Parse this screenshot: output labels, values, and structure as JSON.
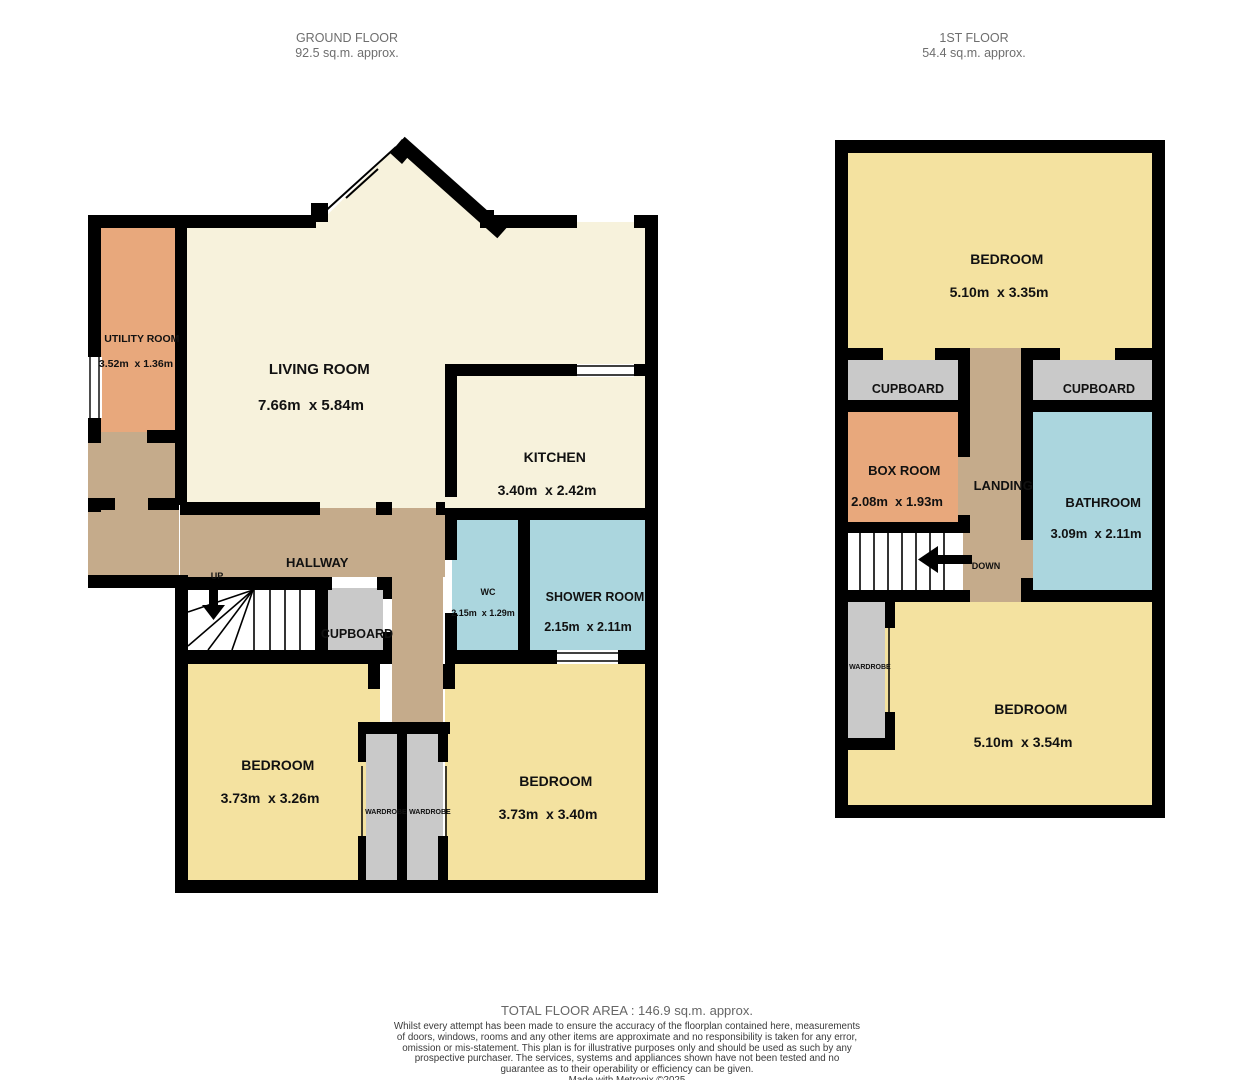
{
  "colors": {
    "wall": "#000000",
    "floor_cream": "#f7f2dc",
    "floor_yellow": "#f4e2a0",
    "floor_orange": "#e8a87c",
    "floor_tan": "#c5ab8b",
    "floor_blue": "#abd6de",
    "floor_gray": "#c9c9c9",
    "stair_white": "#ffffff",
    "header_text": "#6e6e6e",
    "label_text": "#111111",
    "footer_text": "#666666",
    "disclaimer_text": "#3a3a3a"
  },
  "ground_floor": {
    "header": {
      "title": "GROUND FLOOR",
      "area": "92.5 sq.m. approx."
    },
    "rooms": {
      "utility": {
        "name": "UTILITY ROOM",
        "dims": "3.52m  x 1.36m"
      },
      "living": {
        "name": "LIVING ROOM",
        "dims": "7.66m  x 5.84m"
      },
      "kitchen": {
        "name": "KITCHEN",
        "dims": "3.40m  x 2.42m"
      },
      "hallway": {
        "name": "HALLWAY"
      },
      "wc": {
        "name": "WC",
        "dims": "2.15m  x 1.29m"
      },
      "shower_room": {
        "name": "SHOWER ROOM",
        "dims": "2.15m  x 2.11m"
      },
      "cupboard": {
        "name": "CUPBOARD"
      },
      "bedroom_left": {
        "name": "BEDROOM",
        "dims": "3.73m  x 3.26m"
      },
      "bedroom_right": {
        "name": "BEDROOM",
        "dims": "3.73m  x 3.40m"
      },
      "wardrobe_left": {
        "name": "WARDROBE"
      },
      "wardrobe_right": {
        "name": "WARDROBE"
      }
    },
    "stairs": {
      "direction_label": "UP"
    }
  },
  "first_floor": {
    "header": {
      "title": "1ST FLOOR",
      "area": "54.4 sq.m. approx."
    },
    "rooms": {
      "bedroom_top": {
        "name": "BEDROOM",
        "dims": "5.10m  x 3.35m"
      },
      "cupboard_left": {
        "name": "CUPBOARD"
      },
      "cupboard_right": {
        "name": "CUPBOARD"
      },
      "box_room": {
        "name": "BOX ROOM",
        "dims": "2.08m  x 1.93m"
      },
      "landing": {
        "name": "LANDING"
      },
      "bathroom": {
        "name": "BATHROOM",
        "dims": "3.09m  x 2.11m"
      },
      "bedroom_bottom": {
        "name": "BEDROOM",
        "dims": "5.10m  x 3.54m"
      },
      "wardrobe": {
        "name": "WARDROBE"
      }
    },
    "stairs": {
      "direction_label": "DOWN"
    }
  },
  "footer": {
    "total_area": "TOTAL FLOOR AREA : 146.9 sq.m. approx.",
    "disclaimer": "Whilst every attempt has been made to ensure the accuracy of the floorplan contained here, measurements of doors, windows, rooms and any other items are approximate and no responsibility is taken for any error, omission or mis-statement. This plan is for illustrative purposes only and should be used as such by any prospective purchaser. The services, systems and appliances shown have not been tested and no guarantee as to their operability or efficiency can be given.",
    "credit": "Made with Metropix ©2025"
  }
}
